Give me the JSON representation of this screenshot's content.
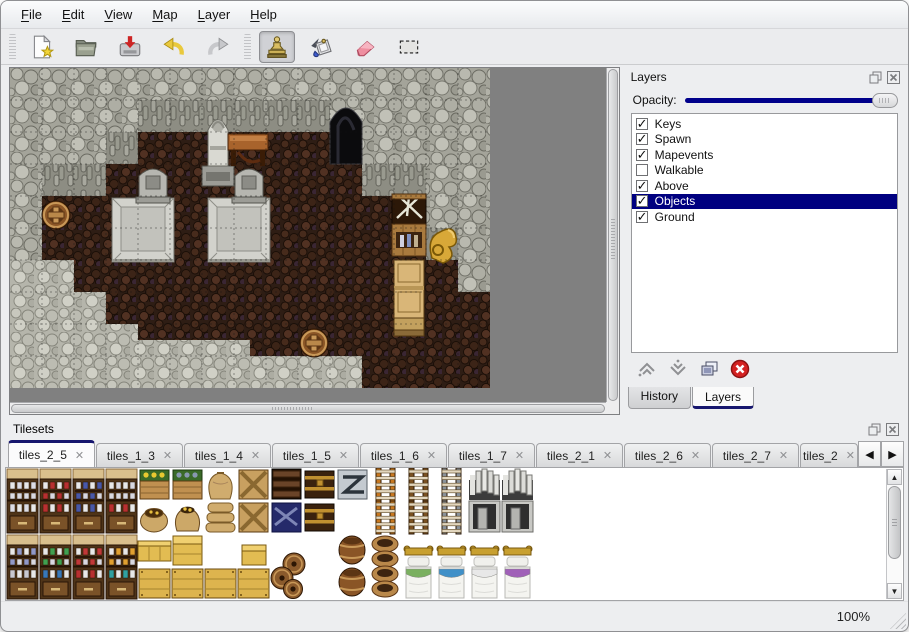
{
  "menu": {
    "items": [
      {
        "label": "File",
        "underline": 0
      },
      {
        "label": "Edit",
        "underline": 0
      },
      {
        "label": "View",
        "underline": 0
      },
      {
        "label": "Map",
        "underline": 0
      },
      {
        "label": "Layer",
        "underline": 0
      },
      {
        "label": "Help",
        "underline": 0
      }
    ]
  },
  "toolbar": {
    "file_buttons": [
      {
        "name": "new"
      },
      {
        "name": "open"
      },
      {
        "name": "save"
      },
      {
        "name": "undo"
      },
      {
        "name": "redo"
      }
    ],
    "tool_buttons": [
      {
        "name": "stamp",
        "active": true
      },
      {
        "name": "fill",
        "active": false
      },
      {
        "name": "eraser",
        "active": false
      },
      {
        "name": "select",
        "active": false
      }
    ]
  },
  "layers_panel": {
    "title": "Layers",
    "opacity_label": "Opacity:",
    "opacity_percent": 100,
    "layers": [
      {
        "name": "Keys",
        "checked": true,
        "selected": false
      },
      {
        "name": "Spawn",
        "checked": true,
        "selected": false
      },
      {
        "name": "Mapevents",
        "checked": true,
        "selected": false
      },
      {
        "name": "Walkable",
        "checked": false,
        "selected": false
      },
      {
        "name": "Above",
        "checked": true,
        "selected": false
      },
      {
        "name": "Objects",
        "checked": true,
        "selected": true
      },
      {
        "name": "Ground",
        "checked": true,
        "selected": false
      }
    ],
    "buttons": [
      {
        "name": "raise-layer"
      },
      {
        "name": "lower-layer"
      },
      {
        "name": "duplicate-layer"
      },
      {
        "name": "delete-layer"
      }
    ],
    "tabs": [
      {
        "label": "History",
        "active": false
      },
      {
        "label": "Layers",
        "active": true
      }
    ]
  },
  "tilesets_panel": {
    "title": "Tilesets",
    "tabs": [
      {
        "label": "tiles_2_5",
        "active": true
      },
      {
        "label": "tiles_1_3",
        "active": false
      },
      {
        "label": "tiles_1_4",
        "active": false
      },
      {
        "label": "tiles_1_5",
        "active": false
      },
      {
        "label": "tiles_1_6",
        "active": false
      },
      {
        "label": "tiles_1_7",
        "active": false
      },
      {
        "label": "tiles_2_1",
        "active": false
      },
      {
        "label": "tiles_2_6",
        "active": false
      },
      {
        "label": "tiles_2_7",
        "active": false
      },
      {
        "label": "tiles_2",
        "active": false,
        "truncated": true
      }
    ],
    "scroll_arrows": [
      "left",
      "right"
    ]
  },
  "statusbar": {
    "zoom": "100%"
  },
  "colors": {
    "selection_navy": "#000080",
    "slider_navy": "#00008b",
    "tab_accent": "#16166e",
    "map_bg": "#808080"
  },
  "map": {
    "tile_px": 32,
    "cols": 15,
    "rows": 10,
    "view_w": 597,
    "view_h": 334,
    "floor_rects": [
      [
        128,
        64,
        192,
        32
      ],
      [
        96,
        96,
        256,
        32
      ],
      [
        32,
        128,
        384,
        32
      ],
      [
        32,
        160,
        384,
        32
      ],
      [
        64,
        192,
        384,
        32
      ],
      [
        64,
        224,
        416,
        32
      ],
      [
        96,
        256,
        384,
        32
      ],
      [
        288,
        288,
        192,
        32
      ]
    ],
    "wall_face_rects": [
      [
        128,
        32,
        192,
        32
      ],
      [
        96,
        64,
        32,
        32
      ],
      [
        32,
        96,
        64,
        32
      ],
      [
        352,
        96,
        64,
        32
      ],
      [
        416,
        160,
        32,
        32
      ]
    ],
    "ground_polygon": "0,192 64,192 64,224 96,224 96,256 128,256 128,272 240,272 240,288 352,288 352,320 0,320",
    "cave": {
      "x": 320,
      "y": 32,
      "w": 32,
      "h": 64
    },
    "objects": [
      {
        "type": "slab",
        "x": 102,
        "y": 130
      },
      {
        "type": "slab",
        "x": 198,
        "y": 130
      },
      {
        "type": "tombstone",
        "x": 126,
        "y": 96
      },
      {
        "type": "tombstone",
        "x": 222,
        "y": 96
      },
      {
        "type": "statue",
        "x": 190,
        "y": 42
      },
      {
        "type": "table",
        "x": 218,
        "y": 60
      },
      {
        "type": "barrel",
        "x": 30,
        "y": 130
      },
      {
        "type": "crate_stack",
        "x": 382,
        "y": 126
      },
      {
        "type": "gold_sack",
        "x": 418,
        "y": 156
      },
      {
        "type": "cabinet",
        "x": 384,
        "y": 192
      },
      {
        "type": "barrel",
        "x": 288,
        "y": 258
      }
    ]
  },
  "palette": {
    "tile_px": 33,
    "cols": 16,
    "rows": 4,
    "tiles": [
      {
        "t": "shelf_top",
        "c": 0,
        "r": 0,
        "a": "#dcdce4"
      },
      {
        "t": "shelf_top",
        "c": 1,
        "r": 0,
        "a": "#b83030"
      },
      {
        "t": "shelf_top",
        "c": 2,
        "r": 0,
        "a": "#4858a8"
      },
      {
        "t": "shelf_top",
        "c": 3,
        "r": 0,
        "a": "#d8d8e0"
      },
      {
        "t": "crate_plants",
        "c": 4,
        "r": 0,
        "a": "#e8c830"
      },
      {
        "t": "crate_plants",
        "c": 5,
        "r": 0,
        "a": "#8898b0"
      },
      {
        "t": "sack_tall",
        "c": 6,
        "r": 0
      },
      {
        "t": "crate_x",
        "c": 7,
        "r": 0
      },
      {
        "t": "crate_dark",
        "c": 8,
        "r": 0
      },
      {
        "t": "chest",
        "c": 9,
        "r": 0
      },
      {
        "t": "crate_metal",
        "c": 10,
        "r": 0
      },
      {
        "t": "ladder",
        "c": 11,
        "r": 0,
        "a": "#c87820"
      },
      {
        "t": "ladder",
        "c": 12,
        "r": 0,
        "a": "#7a5020"
      },
      {
        "t": "ladder",
        "c": 13,
        "r": 0,
        "a": "#8a929a"
      },
      {
        "t": "arch_top",
        "c": 14,
        "r": 0
      },
      {
        "t": "arch_top",
        "c": 15,
        "r": 0
      },
      {
        "t": "shelf_bot",
        "c": 0,
        "r": 1,
        "a": "#dcdce4"
      },
      {
        "t": "shelf_bot",
        "c": 1,
        "r": 1,
        "a": "#b83030"
      },
      {
        "t": "shelf_bot",
        "c": 2,
        "r": 1,
        "a": "#4858a8"
      },
      {
        "t": "shelf_bot",
        "c": 3,
        "r": 1,
        "a": "#b83030"
      },
      {
        "t": "sack_open",
        "c": 4,
        "r": 1
      },
      {
        "t": "sack_gold",
        "c": 5,
        "r": 1
      },
      {
        "t": "sack_pile",
        "c": 6,
        "r": 1
      },
      {
        "t": "crate_x",
        "c": 7,
        "r": 1
      },
      {
        "t": "crate_navy",
        "c": 8,
        "r": 1
      },
      {
        "t": "chest",
        "c": 9,
        "r": 1
      },
      {
        "t": "ladder",
        "c": 11,
        "r": 1,
        "a": "#c87820"
      },
      {
        "t": "ladder",
        "c": 12,
        "r": 1,
        "a": "#7a5020"
      },
      {
        "t": "ladder",
        "c": 13,
        "r": 1,
        "a": "#8a929a"
      },
      {
        "t": "arch_bot",
        "c": 14,
        "r": 1
      },
      {
        "t": "arch_bot",
        "c": 15,
        "r": 1
      },
      {
        "t": "shelf_top",
        "c": 0,
        "r": 2,
        "a": "#9098c8"
      },
      {
        "t": "shelf_top",
        "c": 1,
        "r": 2,
        "a": "#40a050"
      },
      {
        "t": "shelf_top",
        "c": 2,
        "r": 2,
        "a": "#c03838"
      },
      {
        "t": "shelf_top",
        "c": 3,
        "r": 2,
        "a": "#e0a030"
      },
      {
        "t": "counter",
        "c": 4,
        "r": 2
      },
      {
        "t": "crate_lid",
        "c": 5,
        "r": 2
      },
      {
        "t": "crate_small",
        "c": 7,
        "r": 2
      },
      {
        "t": "barrels_pile",
        "c": 8,
        "r": 2,
        "h": 2
      },
      {
        "t": "barrels_two",
        "c": 10,
        "r": 2,
        "h": 2
      },
      {
        "t": "pots",
        "c": 11,
        "r": 2,
        "h": 2
      },
      {
        "t": "bed_top",
        "c": 12,
        "r": 2
      },
      {
        "t": "bed_top",
        "c": 13,
        "r": 2
      },
      {
        "t": "bed_top",
        "c": 14,
        "r": 2
      },
      {
        "t": "bed_top",
        "c": 15,
        "r": 2
      },
      {
        "t": "shelf_bot",
        "c": 0,
        "r": 3,
        "a": "#c8c8d0"
      },
      {
        "t": "shelf_bot",
        "c": 1,
        "r": 3,
        "a": "#3878b8"
      },
      {
        "t": "shelf_bot",
        "c": 2,
        "r": 3,
        "a": "#b83030"
      },
      {
        "t": "shelf_bot",
        "c": 3,
        "r": 3,
        "a": "#30a0a0"
      },
      {
        "t": "crate_front",
        "c": 4,
        "r": 3
      },
      {
        "t": "crate_front",
        "c": 5,
        "r": 3
      },
      {
        "t": "crate_front",
        "c": 6,
        "r": 3
      },
      {
        "t": "crate_front",
        "c": 7,
        "r": 3
      },
      {
        "t": "bed_bot",
        "c": 12,
        "r": 3,
        "a": "#7ab060"
      },
      {
        "t": "bed_bot",
        "c": 13,
        "r": 3,
        "a": "#4090c8"
      },
      {
        "t": "bed_bot",
        "c": 14,
        "r": 3,
        "a": "#e8e8e8"
      },
      {
        "t": "bed_bot",
        "c": 15,
        "r": 3,
        "a": "#a060b8"
      }
    ]
  }
}
